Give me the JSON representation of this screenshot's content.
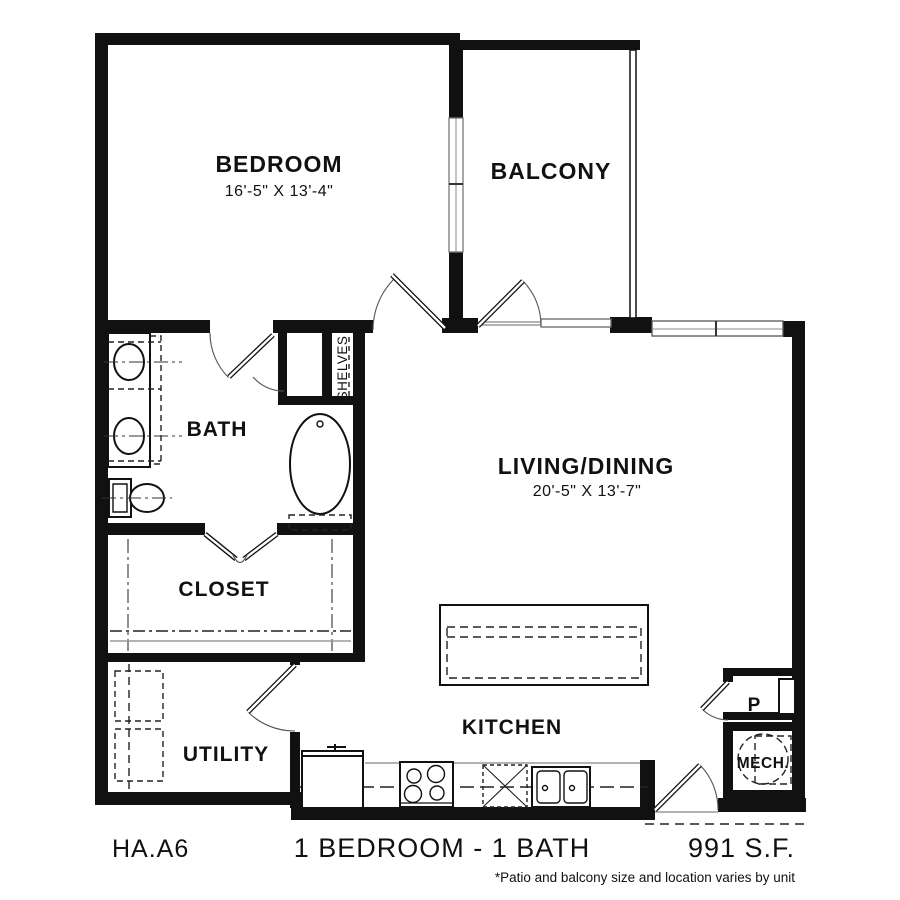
{
  "plan": {
    "rooms": {
      "bedroom": {
        "label": "BEDROOM",
        "dims": "16'-5\" X 13'-4\""
      },
      "balcony": {
        "label": "BALCONY"
      },
      "bath": {
        "label": "BATH"
      },
      "shelves": {
        "label": "SHELVES"
      },
      "living_dining": {
        "label": "LIVING/DINING",
        "dims": "20'-5\" X 13'-7\""
      },
      "closet": {
        "label": "CLOSET"
      },
      "utility": {
        "label": "UTILITY"
      },
      "kitchen": {
        "label": "KITCHEN"
      },
      "pantry": {
        "label": "P"
      },
      "mechanical": {
        "label": "MECH."
      }
    },
    "footer": {
      "unit_code": "HA.A6",
      "configuration": "1 BEDROOM - 1 BATH",
      "area": "991 S.F.",
      "footnote": "*Patio and balcony size and location varies by unit"
    },
    "colors": {
      "wall": "#111111",
      "background": "#ffffff",
      "thin_line": "#9a9a9a",
      "dashed_line": "#222222"
    }
  }
}
